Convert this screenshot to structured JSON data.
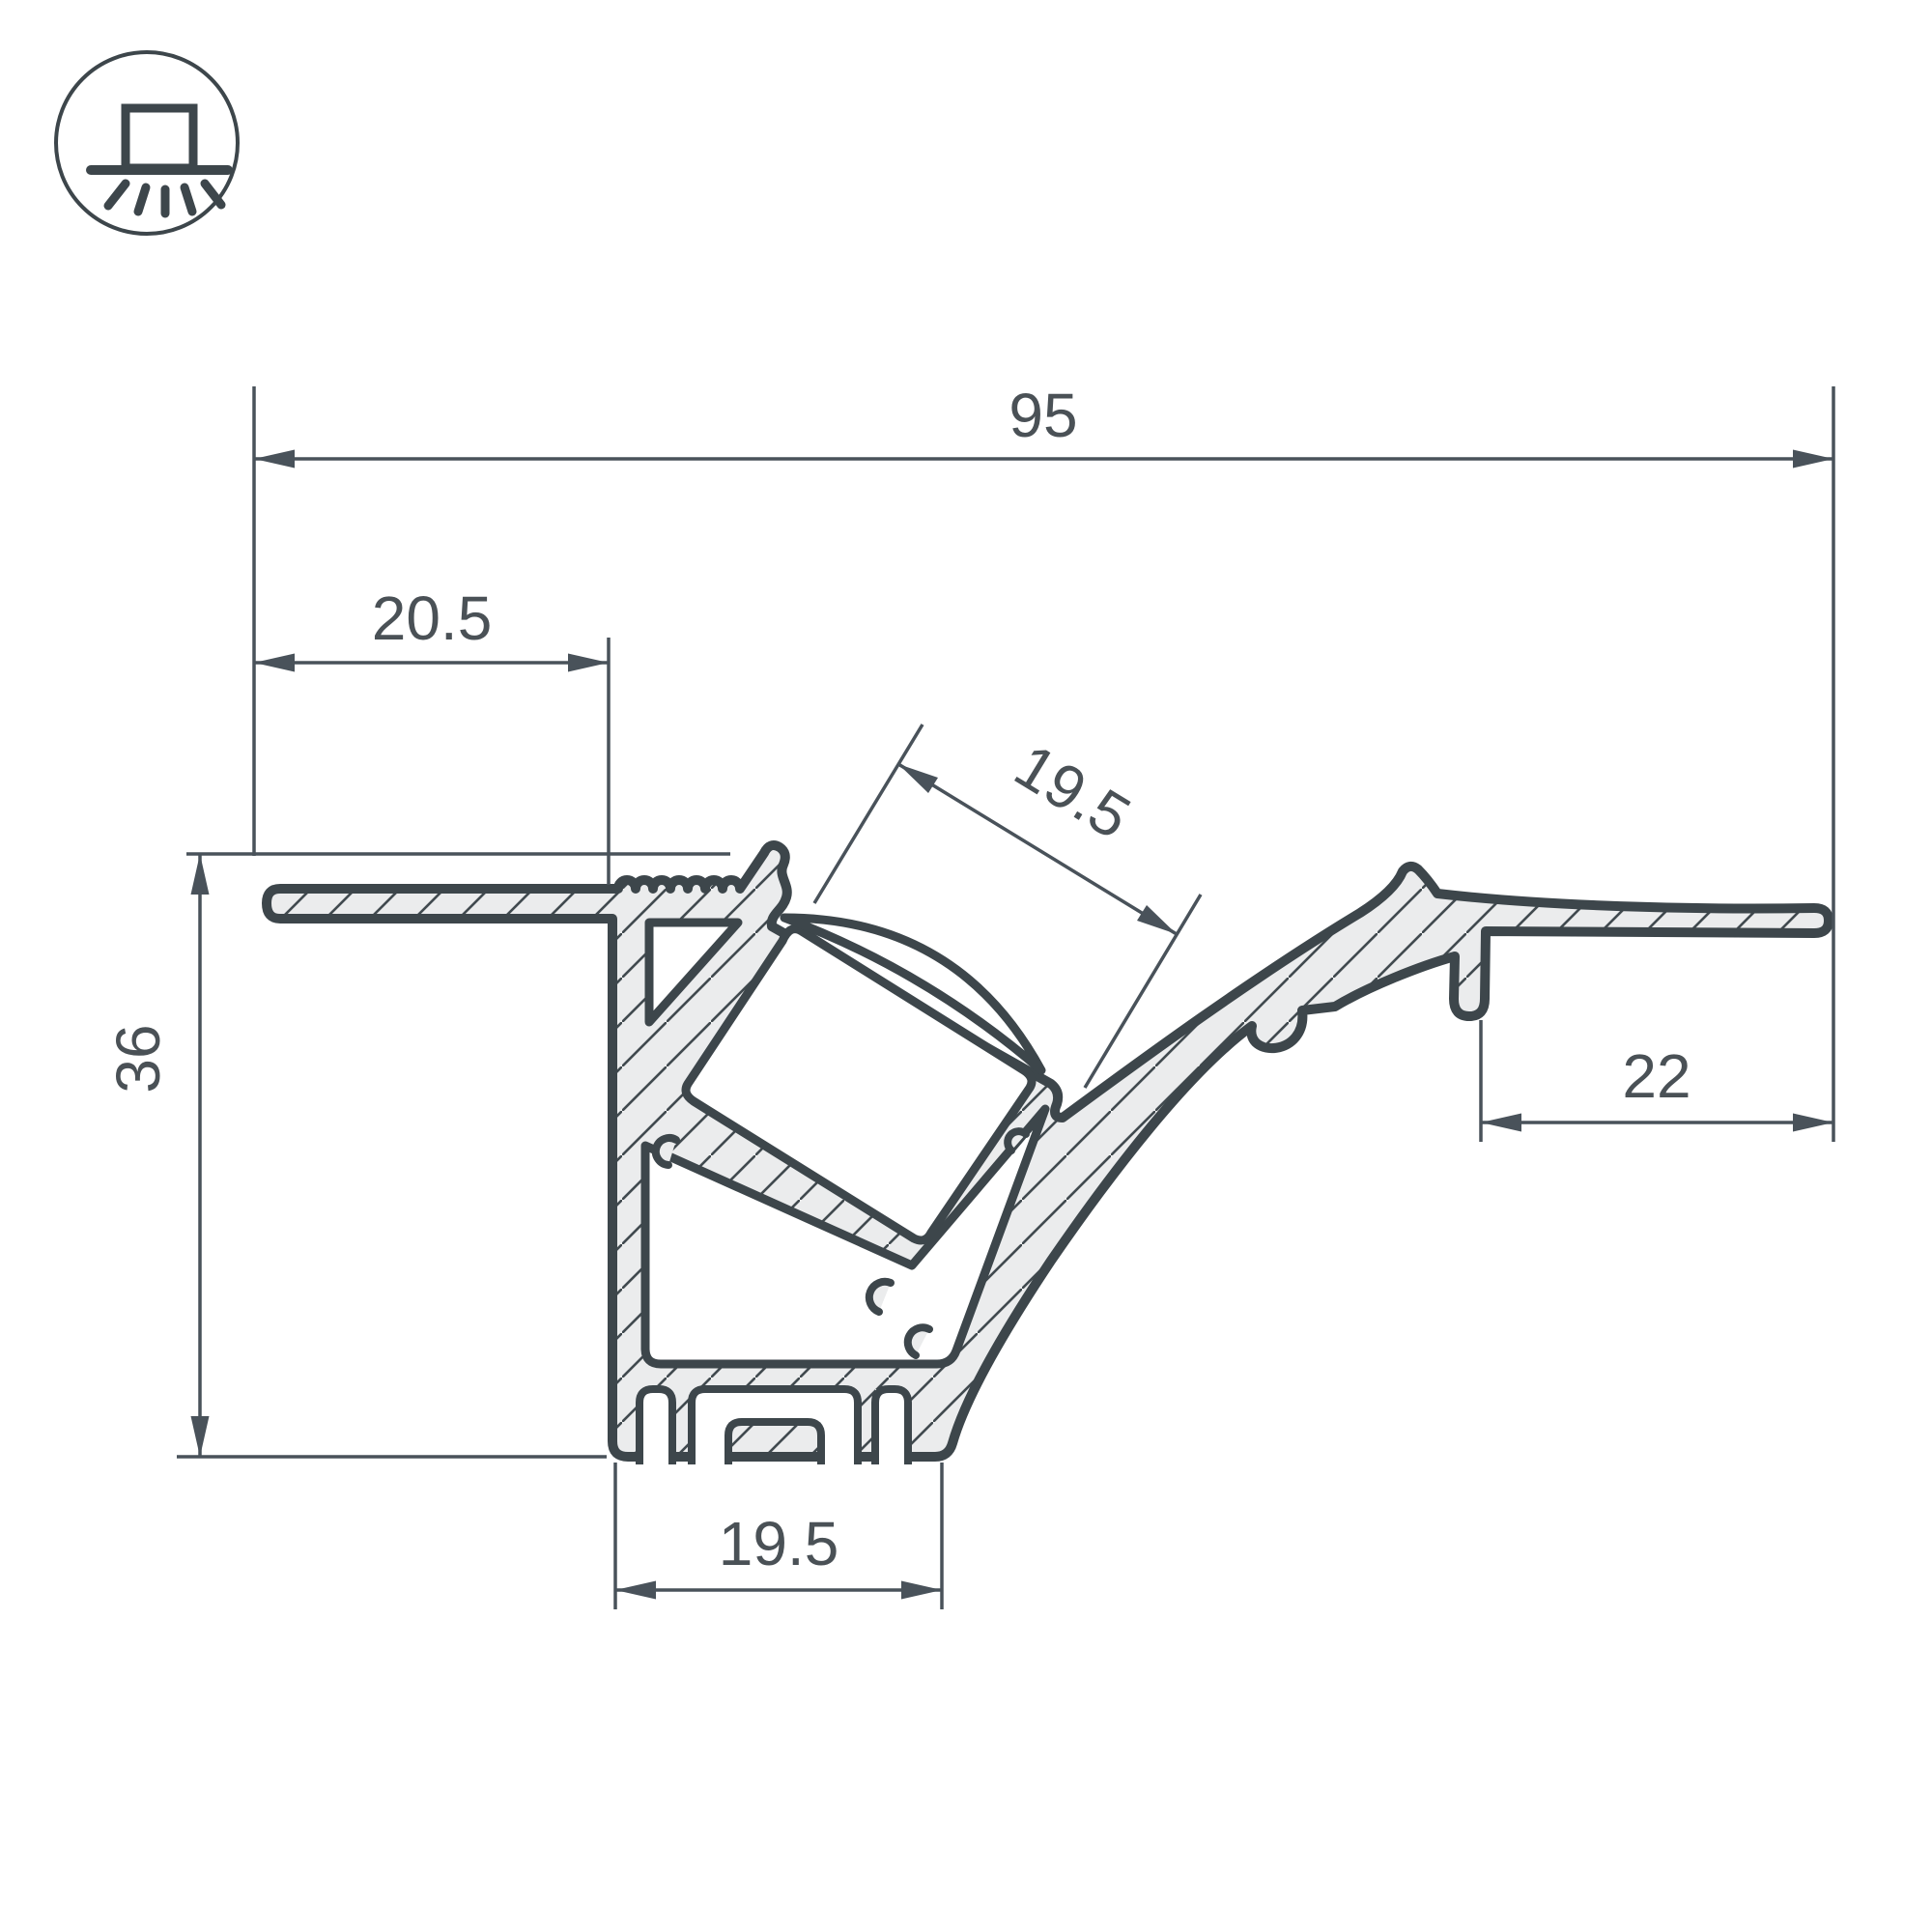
{
  "drawing": {
    "title": "LED profile cross-section technical drawing",
    "icon": {
      "name": "recessed-light-icon"
    },
    "dimensions": {
      "overall_width": "95",
      "left_flange_offset": "20.5",
      "channel_opening_width": "19.5",
      "overall_height": "36",
      "right_flange_width": "22",
      "base_width": "19.5"
    },
    "colors": {
      "outline": "#3d464b",
      "material_fill": "#ebeced",
      "hatch_line": "#414a4f",
      "dimension_line": "#49525a",
      "dimension_text": "#4a5156",
      "background": "#ffffff"
    }
  }
}
